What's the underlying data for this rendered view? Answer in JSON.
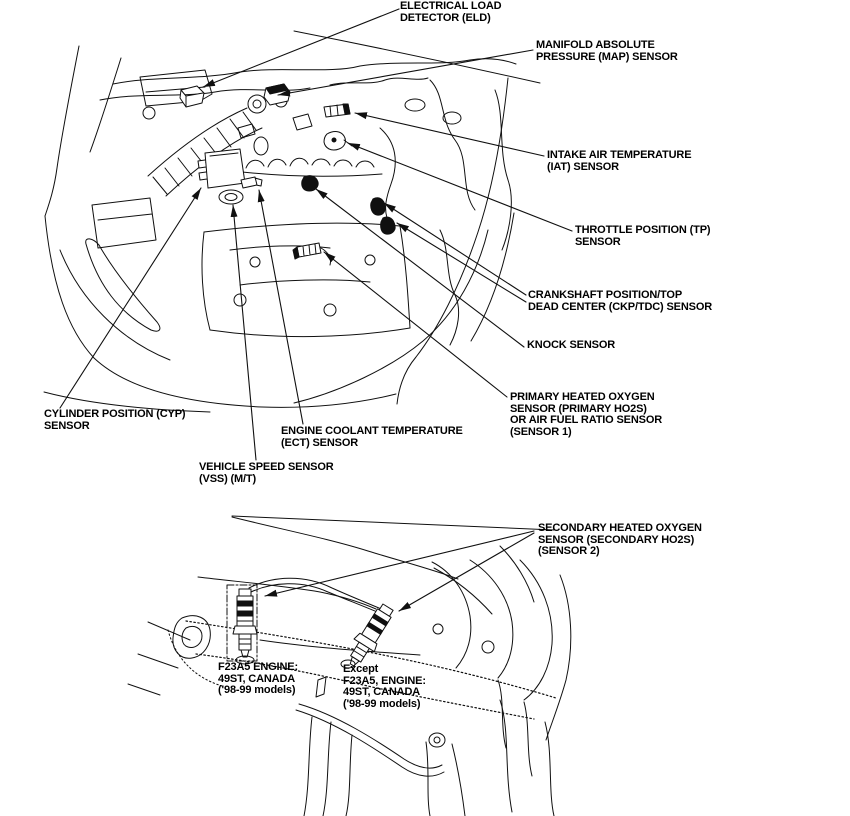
{
  "page": {
    "background": "#ffffff",
    "ink": "#101010"
  },
  "callouts": {
    "eld": "ELECTRICAL LOAD\nDETECTOR (ELD)",
    "map": "MANIFOLD ABSOLUTE\nPRESSURE (MAP) SENSOR",
    "iat": "INTAKE AIR TEMPERATURE\n(IAT) SENSOR",
    "tp": "THROTTLE POSITION (TP)\nSENSOR",
    "ckp_tdc": "CRANKSHAFT POSITION/TOP\nDEAD CENTER (CKP/TDC) SENSOR",
    "knock": "KNOCK SENSOR",
    "primary_ho2s": "PRIMARY HEATED OXYGEN\nSENSOR (PRIMARY HO2S)\nOR AIR FUEL RATIO SENSOR\n(SENSOR 1)",
    "cyp": "CYLINDER POSITION (CYP)\nSENSOR",
    "ect": "ENGINE COOLANT TEMPERATURE\n(ECT) SENSOR",
    "vss": "VEHICLE SPEED SENSOR\n(VSS) (M/T)",
    "secondary_ho2s": "SECONDARY HEATED OXYGEN\nSENSOR (SECONDARY HO2S)\n(SENSOR 2)",
    "engine_variant_left": "F23A5 ENGINE:\n49ST, CANADA\n('98-99 models)",
    "engine_variant_right": "Except\nF23A5, ENGINE:\n49ST, CANADA\n('98-99 models)"
  }
}
